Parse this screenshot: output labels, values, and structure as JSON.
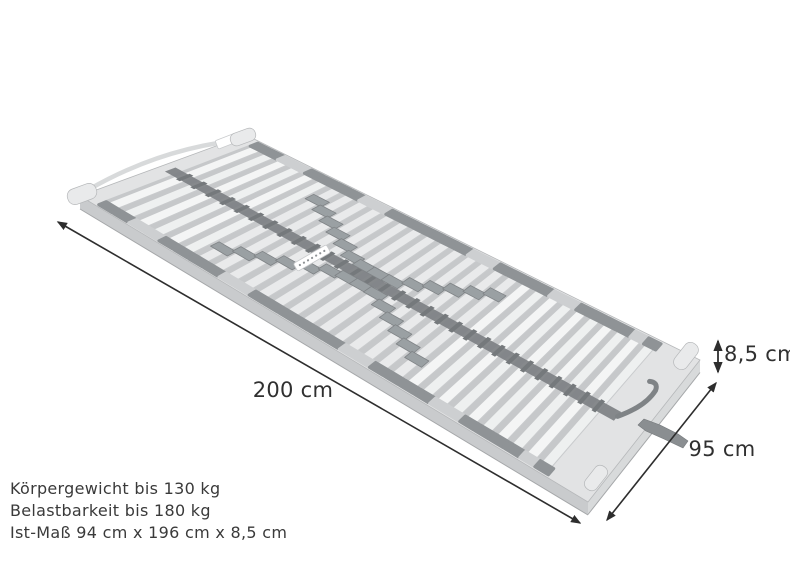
{
  "dimension_labels": {
    "length": "200 cm",
    "width": "95 cm",
    "height": "8,5 cm"
  },
  "specs": [
    "Körpergewicht bis 130 kg",
    "Belastbarkeit bis 180 kg",
    "Ist-Maß 94 cm x 196 cm x 8,5 cm"
  ],
  "colors": {
    "background": "#ffffff",
    "frame_top": "#e2e3e4",
    "frame_side": "#c9cbcd",
    "frame_foot_face": "#d8dadb",
    "frame_outline": "#b5b7b9",
    "frame_shadow": "#a5a7a9",
    "deck": "#c6c8ca",
    "slat": "#f4f5f5",
    "slat_alt": "#eef0f0",
    "slat_mid": "#e9eaeb",
    "slat_edge": "#c9cbcd",
    "cap_dark": "#8f9396",
    "cap_light": "#cdcfd1",
    "corner_cap": "#e9eaeb",
    "strap": "#7f8386",
    "strap_clip": "#75797c",
    "slider": "#9aa0a3",
    "handle": "#8a8e91",
    "dimension_line": "#2e2e2e",
    "dimension_text": "#303030",
    "text": "#3a3a3a",
    "tag_white": "#ffffff"
  }
}
